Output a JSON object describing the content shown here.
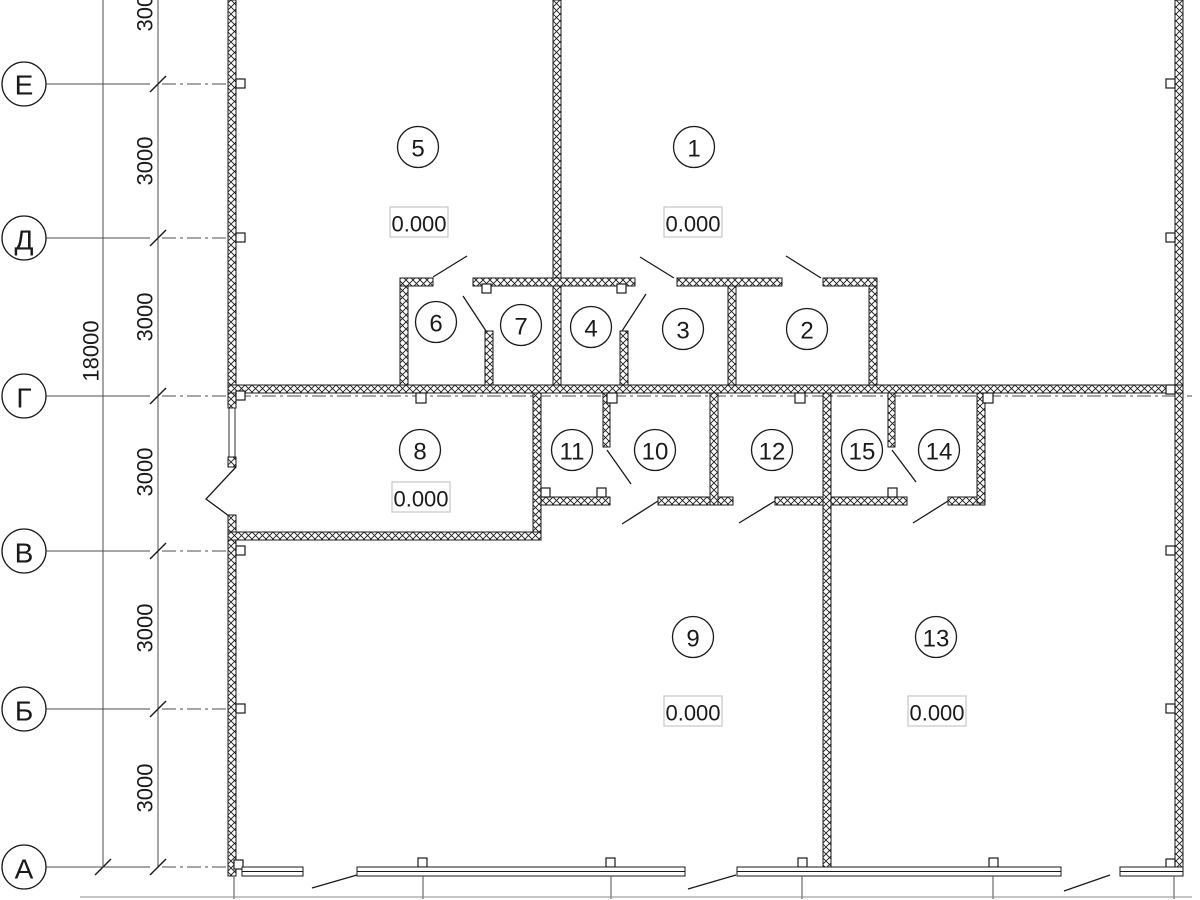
{
  "drawing_type": "architectural-floor-plan",
  "axes": {
    "letters": [
      "Е",
      "Д",
      "Г",
      "В",
      "Б",
      "А"
    ]
  },
  "dimensions": {
    "total": "18000",
    "segments": [
      "3000",
      "3000",
      "3000",
      "3000",
      "3000",
      "3000"
    ]
  },
  "rooms": [
    {
      "number": "5",
      "elevation": "0.000"
    },
    {
      "number": "1",
      "elevation": "0.000"
    },
    {
      "number": "6"
    },
    {
      "number": "7"
    },
    {
      "number": "4"
    },
    {
      "number": "3"
    },
    {
      "number": "2"
    },
    {
      "number": "8",
      "elevation": "0.000"
    },
    {
      "number": "11"
    },
    {
      "number": "10"
    },
    {
      "number": "12"
    },
    {
      "number": "15"
    },
    {
      "number": "14"
    },
    {
      "number": "9",
      "elevation": "0.000"
    },
    {
      "number": "13",
      "elevation": "0.000"
    }
  ],
  "colors": {
    "line": "#1a1a1a",
    "dim_line": "#4d4d4d",
    "elevation_box_border": "#c6c6c6",
    "background": "#ffffff"
  }
}
